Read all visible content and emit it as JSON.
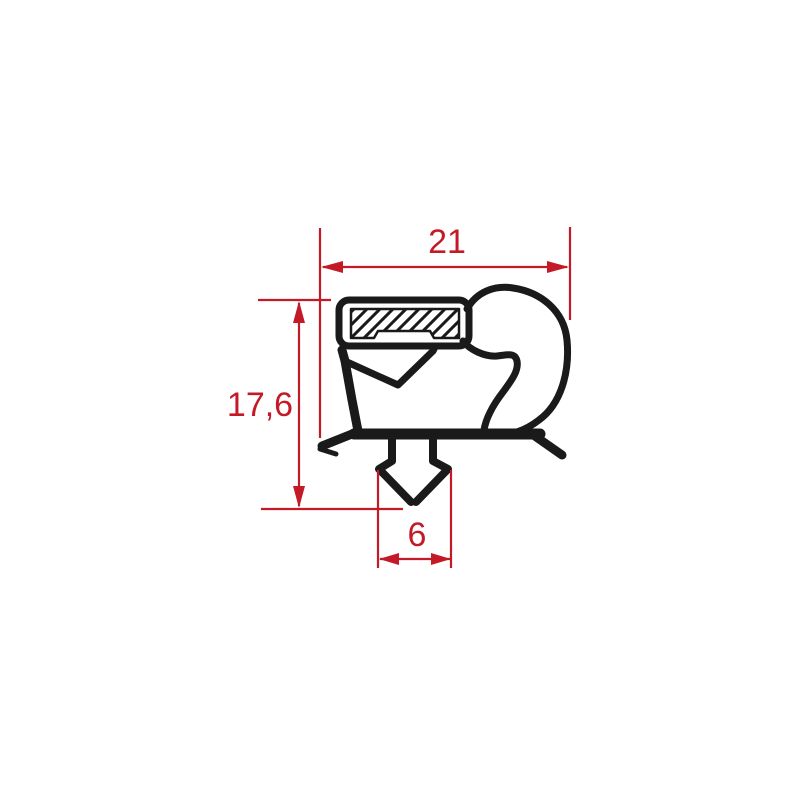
{
  "drawing": {
    "type": "technical-profile-drawing",
    "subject": "door-gasket-cross-section",
    "dimensions": {
      "width": {
        "label": "21"
      },
      "height": {
        "label": "17,6"
      },
      "foot_width": {
        "label": "6"
      }
    },
    "colors": {
      "dimension_red": "#c41a28",
      "profile_black": "#1a1a1a",
      "background": "#ffffff"
    }
  }
}
